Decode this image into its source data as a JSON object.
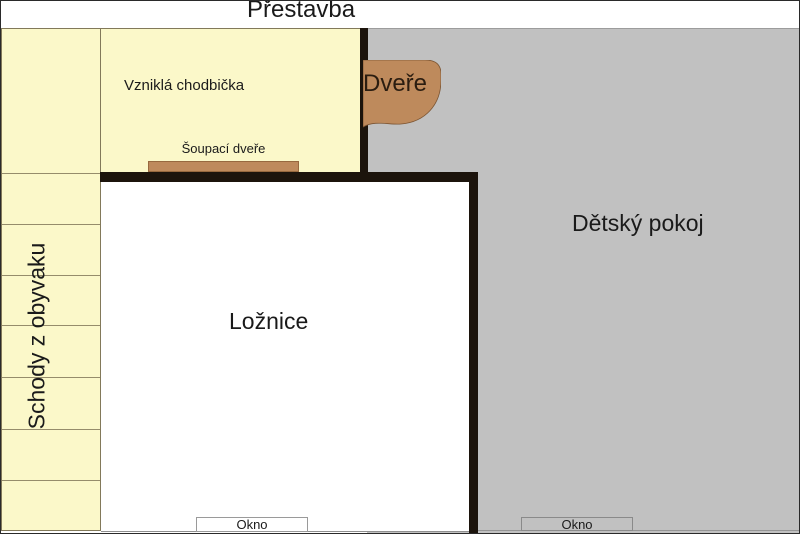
{
  "title": "Přestavba",
  "rooms": {
    "hallway": {
      "label": "Vzniklá chodbička"
    },
    "stairs": {
      "label": "Schody z obyvaku"
    },
    "bedroom": {
      "label": "Ložnice"
    },
    "kids_room": {
      "label": "Dětský pokoj"
    }
  },
  "doors": {
    "swing": {
      "label": "Dveře"
    },
    "sliding": {
      "label": "Šoupací dveře"
    }
  },
  "windows": {
    "bedroom": {
      "label": "Okno"
    },
    "kids_room": {
      "label": "Okno"
    }
  },
  "colors": {
    "room_yellow": "#FBF8C9",
    "room_gray": "#C1C1C1",
    "door_brown": "#BE8A5C",
    "wall_black": "#1C140C"
  },
  "stairs_step_lines_y": [
    171,
    222,
    273,
    323,
    375,
    427,
    478
  ]
}
